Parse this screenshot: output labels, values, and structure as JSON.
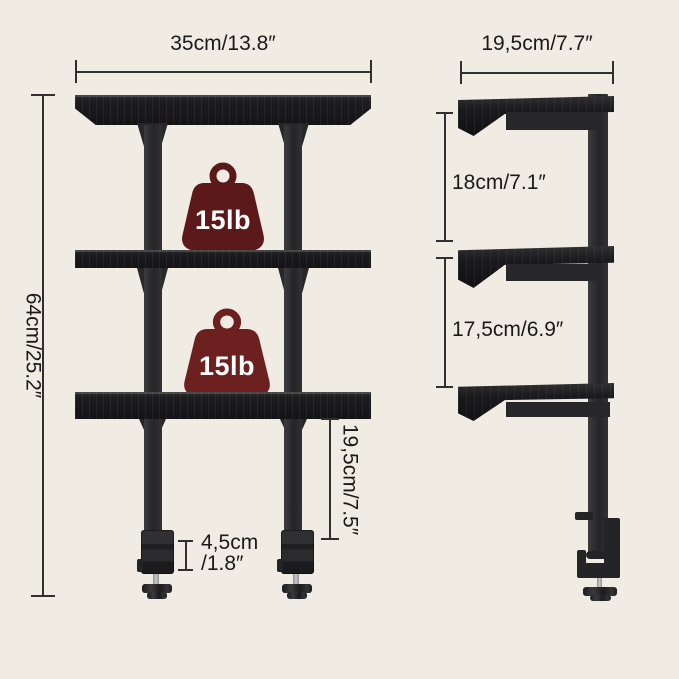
{
  "colors": {
    "background": "#f0ece3",
    "structure": "#232326",
    "dimension_line": "#303030",
    "label_text": "#1a1a1a",
    "weight_badge_1": "#5c1919",
    "weight_badge_2": "#6d2020",
    "weight_text": "#ffffff"
  },
  "front_view": {
    "width_label": "35cm/13.8″",
    "height_label": "64cm/25.2″",
    "shelf_to_clamp_label": "19,5cm/7.5″",
    "clamp_opening_line1": "4,5cm",
    "clamp_opening_line2": "/1.8″",
    "weights": [
      {
        "label": "15lb"
      },
      {
        "label": "15lb"
      }
    ]
  },
  "side_view": {
    "depth_label": "19,5cm/7.7″",
    "top_tier_label": "18cm/7.1″",
    "middle_tier_label": "17,5cm/6.9″"
  }
}
